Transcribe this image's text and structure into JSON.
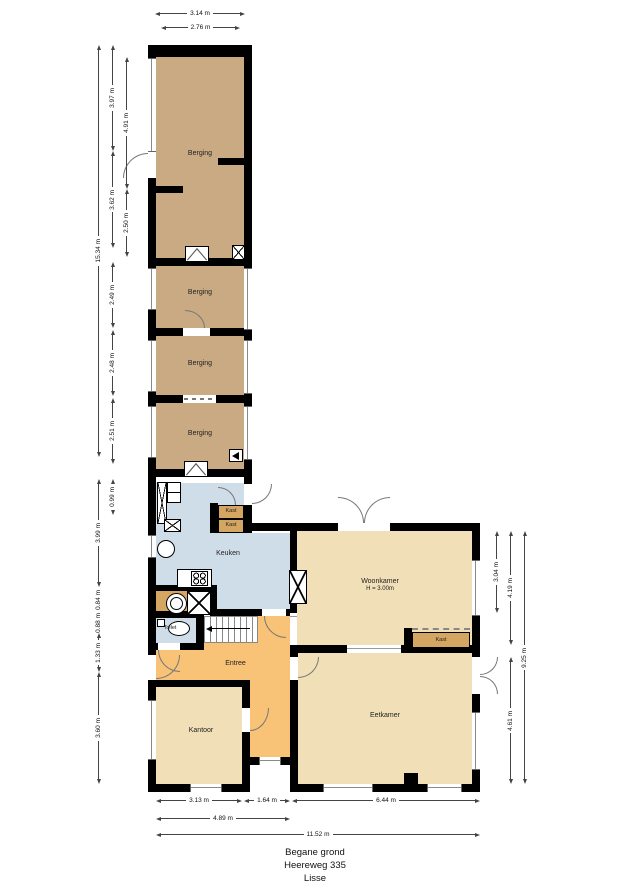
{
  "plan": {
    "title_lines": [
      "Begane grond",
      "Heereweg 335",
      "Lisse"
    ]
  },
  "rooms": {
    "berging": "Berging",
    "keuken": "Keuken",
    "woonkamer": "Woonkamer",
    "woonkamer_height": "H = 3.00m",
    "eetkamer": "Eetkamer",
    "entree": "Entree",
    "kantoor": "Kantoor",
    "toilet": "Toilet",
    "kast": "Kast"
  },
  "dimensions": {
    "top": [
      "3.14 m",
      "2.76 m"
    ],
    "left": [
      "15.34 m",
      "3.97 m",
      "4.91 m",
      "3.62 m",
      "2.50 m",
      "2.49 m",
      "2.48 m",
      "2.51 m",
      "0.99 m",
      "3.99 m",
      "0.84 m",
      "0.88 m",
      "1.33 m",
      "3.60 m"
    ],
    "right": [
      "3.04 m",
      "4.19 m",
      "4.61 m",
      "9.25 m"
    ],
    "bottom": [
      "3.13 m",
      "1.64 m",
      "6.44 m",
      "4.89 m",
      "11.52 m"
    ]
  },
  "colors": {
    "wall": "#000000",
    "berging": "#c9aa83",
    "living": "#f1dfb8",
    "entree": "#f8c376",
    "wet": "#cfdde9",
    "kast": "#d4a661"
  },
  "icons": {
    "flue": "x-box",
    "chimney": "x-box",
    "stove": "four-burner-hob",
    "washer": "washing-machine",
    "sink": "round-sink",
    "toilet": "toilet-bowl",
    "stairs": "staircase-up",
    "hatch": "wall-hatch-arrow"
  }
}
